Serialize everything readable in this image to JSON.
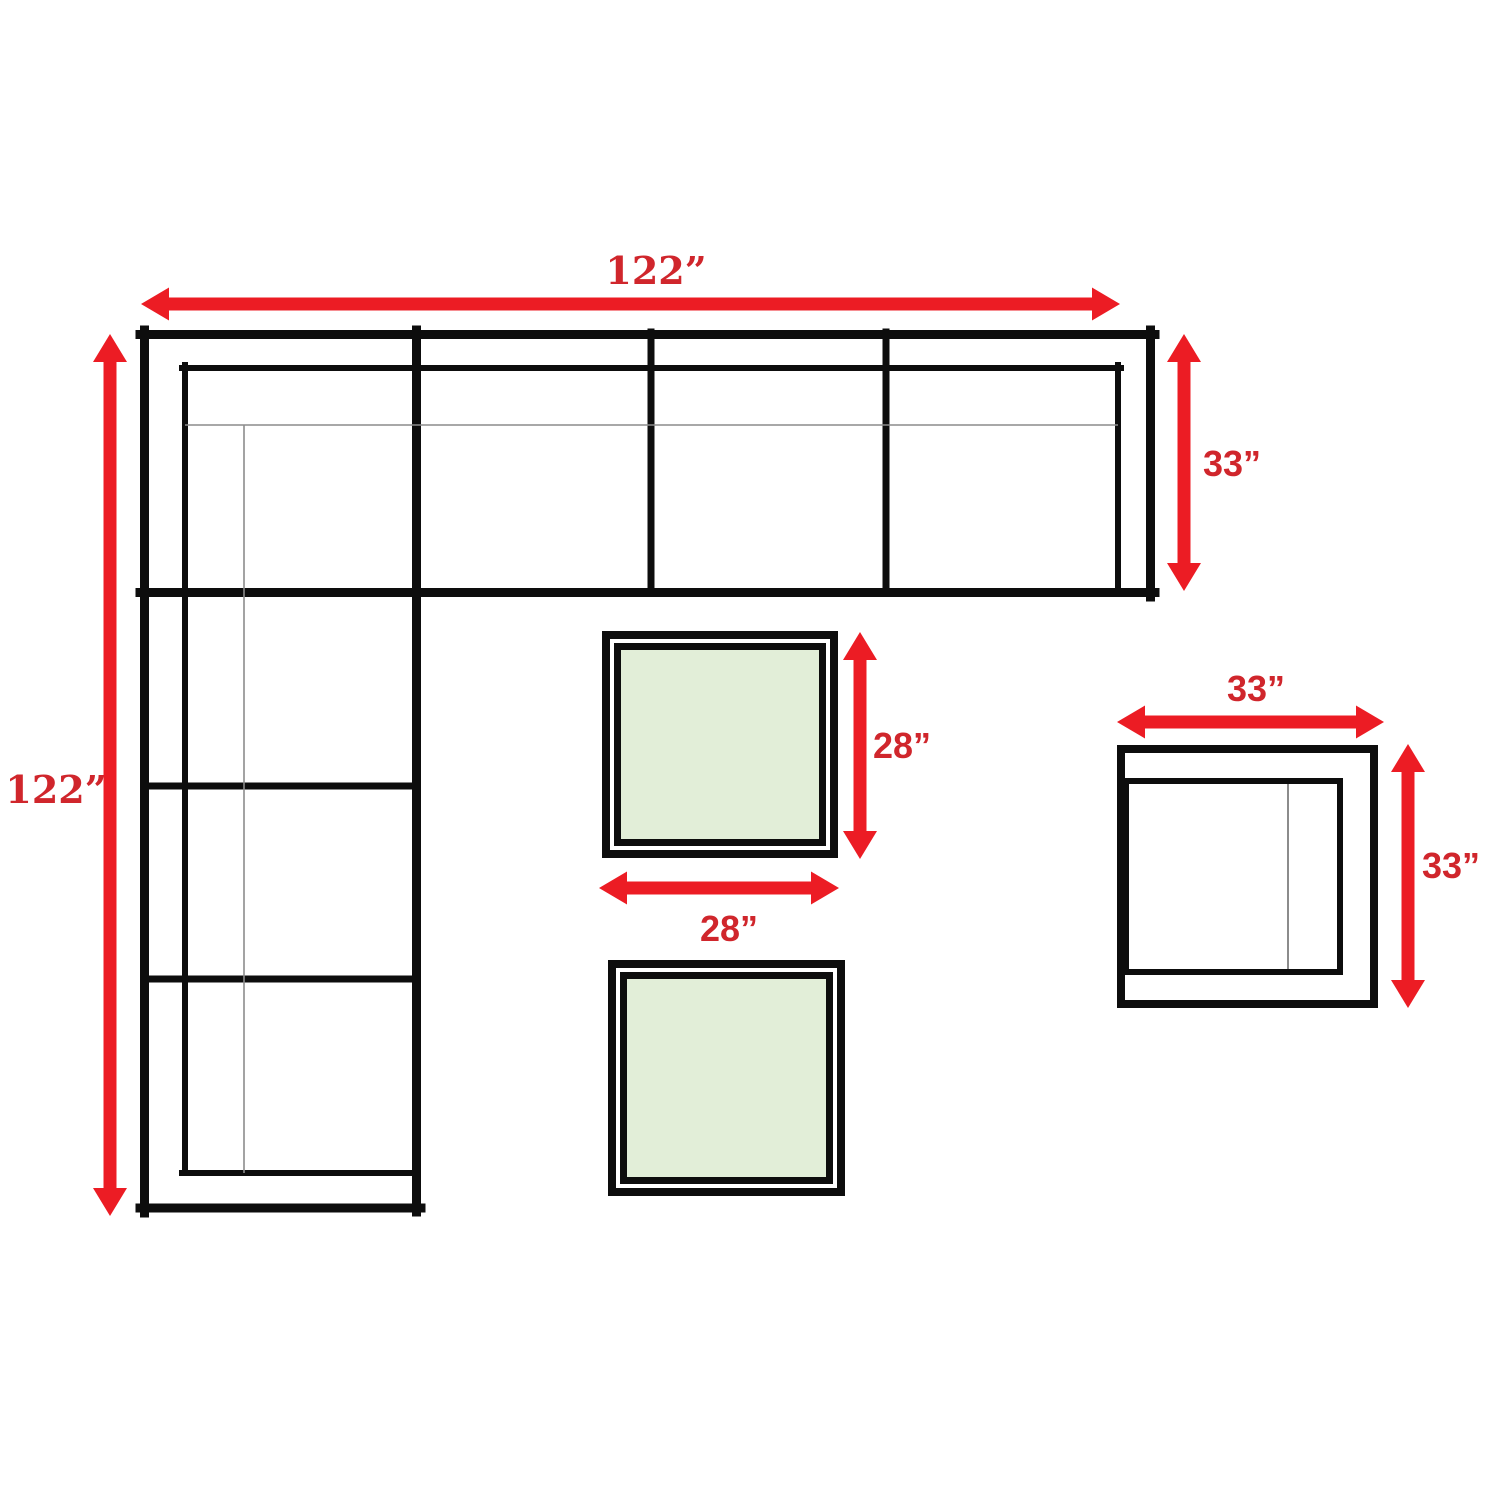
{
  "colors": {
    "background": "#ffffff",
    "outline_black": "#0d0d0d",
    "thin_line_gray": "#8c8c8c",
    "arrow_red": "#ec1c24",
    "label_red": "#d0262c",
    "table_top_green": "#e2eed8",
    "furniture_fill_white": "#ffffff"
  },
  "sectional": {
    "width_label": "122”",
    "height_label": "122”",
    "depth_label": "33”"
  },
  "coffee_table": {
    "depth_label": "28”",
    "width_label": "28”"
  },
  "side_chair": {
    "width_label": "33”",
    "height_label": "33”"
  }
}
